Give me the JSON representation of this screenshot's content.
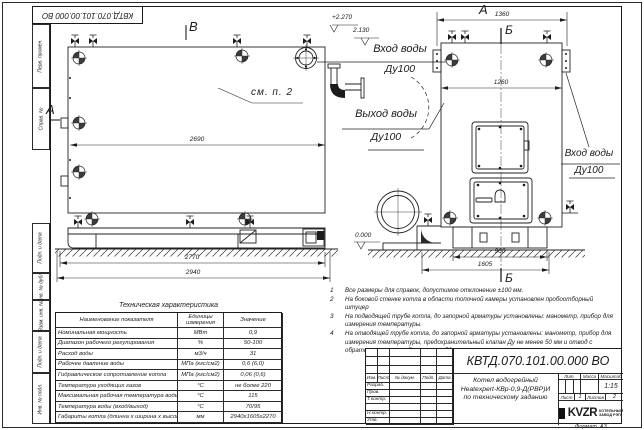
{
  "frame": {
    "doc_number_top": "КВТД.070.101.00.000 ВО",
    "margin_labels": [
      "Перв. примен.",
      "Справ. №",
      "Подп. и дата",
      "Инв. № дубл.",
      "Взам. инв. №",
      "Подп. и дата",
      "Инв. № подл."
    ],
    "format_label": "Формат",
    "format_value": "А3"
  },
  "labels": {
    "view_a_arrow": "А",
    "view_v": "В",
    "view_a_title": "А",
    "section_b_top": "Б",
    "section_b_bottom": "Б",
    "see_item": "см. п. 2",
    "inlet_center_1": "Вход воды",
    "inlet_center_2": "Ду100",
    "outlet_1": "Выход воды",
    "outlet_2": "Ду100",
    "inlet_right_1": "Вход воды",
    "inlet_right_2": "Ду100",
    "elev_top": "+2.270",
    "elev_inlet": "2.130",
    "elev_zero": "0.000"
  },
  "dims": {
    "front_inner": "2690",
    "front_base": "2770",
    "front_overall": "2940",
    "side_top": "1360",
    "side_inner": "1260",
    "side_base": "960",
    "side_overall": "1605"
  },
  "tech_table": {
    "title": "Техническая характеристика",
    "headers": [
      "Наименование показателя",
      "Единицы измерения",
      "Значение"
    ],
    "rows": [
      [
        "Номинальная мощность",
        "МВт",
        "0,9"
      ],
      [
        "Диапазон рабочего регулирования",
        "%",
        "50-100"
      ],
      [
        "Расход воды",
        "м3/ч",
        "31"
      ],
      [
        "Рабочее давление воды",
        "МПа (кгс/см2)",
        "0,6 (6,0)"
      ],
      [
        "Гидравлическое сопротивление котла",
        "МПа (кгс/см2)",
        "0,06 (0,6)"
      ],
      [
        "Температура уходящих газов",
        "°С",
        "не более 220"
      ],
      [
        "Максимальная рабочая температура воды",
        "°С",
        "115"
      ],
      [
        "Температура воды (вход/выход)",
        "°С",
        "70/95"
      ],
      [
        "Габариты котла (длинна х ширина х высота)",
        "мм",
        "2940х1605х2270"
      ]
    ]
  },
  "notes": [
    {
      "n": "1",
      "text": "Все размеры для справок, допустимое отклонение ±100 мм."
    },
    {
      "n": "2",
      "text": "На боковой стенке котла в области топочной камеры установлен пробоотборный штуцер"
    },
    {
      "n": "3",
      "text": "На подводящей трубе котла, до запорной арматуры установлены: манометр, прибор для измерения температуры."
    },
    {
      "n": "4",
      "text": "На отводящей трубе котла, до запорной арматуры установлены: манометр, прибор для измерения температуры, предохранительный клапан Ду не менее 50 мм и отвод с обратным клапаном Ду не менее 50 мм."
    }
  ],
  "title_block": {
    "doc_number": "КВТД.070.101.00.000 ВО",
    "name_line1": "Котел водогрейный",
    "name_line2": "Heatexpert-КВр-0,9-Д(РВР)И",
    "name_line3": "по техническому заданию",
    "cols": [
      "Изм.",
      "Лист",
      "№ докум.",
      "Подп.",
      "Дата"
    ],
    "rows": [
      "Разраб.",
      "Пров.",
      "Т.контр.",
      "",
      "Н.контр.",
      "Утв."
    ],
    "lit": "Лит.",
    "massa": "Масса",
    "scale": "Масштаб",
    "scale_value": "1:15",
    "sheet": "Лист",
    "sheet_no": "1",
    "sheets": "Листов",
    "sheets_no": "2",
    "logo": "KVZR",
    "org1": "КОТЕЛЬНЫЙ",
    "org2": "ЗАВОД РЭП"
  }
}
